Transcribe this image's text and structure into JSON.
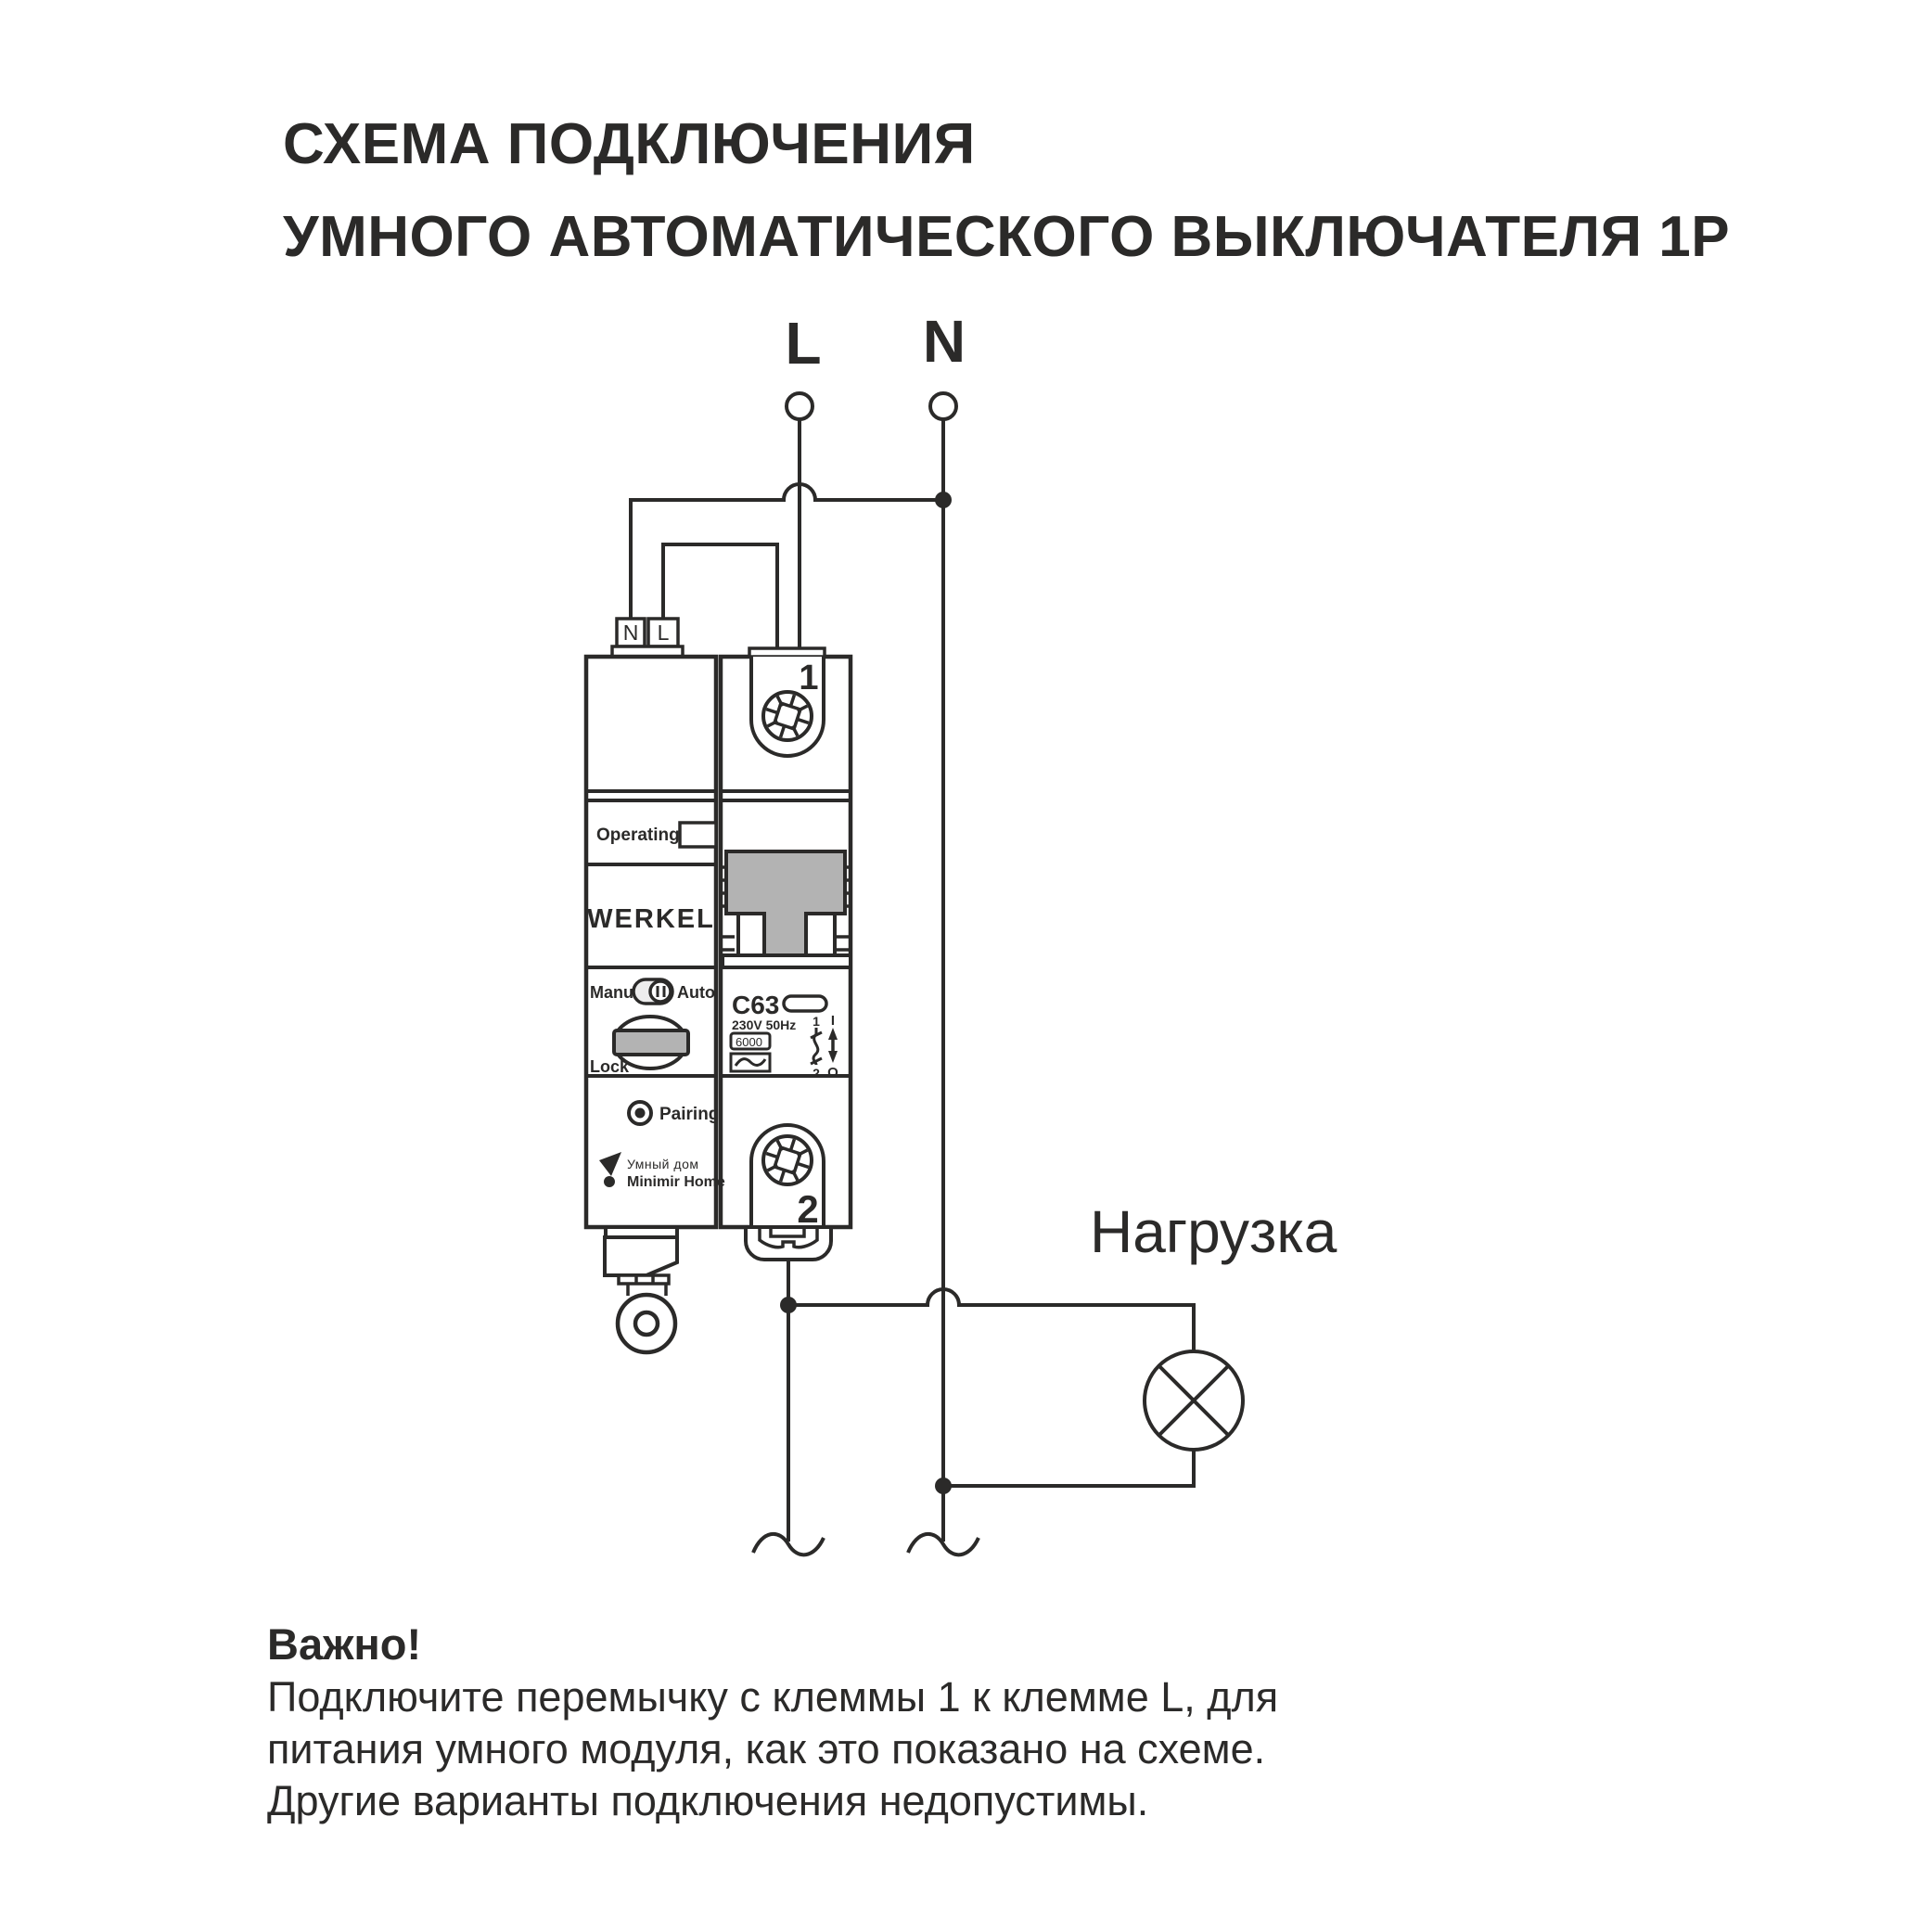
{
  "colors": {
    "line": "#2b2a29",
    "gray_fill": "#b3b3b3",
    "toggle_fill": "#ededed",
    "white": "#ffffff"
  },
  "title": {
    "line1": "СХЕМА ПОДКЛЮЧЕНИЯ",
    "line2": "УМНОГО АВТОМАТИЧЕСКОГО ВЫКЛЮЧАТЕЛЯ 1P"
  },
  "supply": {
    "l": "L",
    "n": "N"
  },
  "load": {
    "label": "Нагрузка"
  },
  "module": {
    "terminal_n": "N",
    "terminal_l": "L",
    "operating": "Operating",
    "brand": "WERKEL",
    "manu": "Manu",
    "auto": "Auto",
    "lock": "Lock",
    "pairing": "Pairing",
    "logo_top": "Умный дом",
    "logo_bottom": "Minimir Home"
  },
  "breaker": {
    "terminal1": "1",
    "terminal2": "2",
    "rating": "C63",
    "voltage": "230V 50Hz",
    "capacity": "6000",
    "contact_top": "1",
    "contact_bottom": "2",
    "on": "I",
    "off": "O"
  },
  "note": {
    "heading": "Важно!",
    "lines": [
      "Подключите перемычку с клеммы 1 к клемме L, для",
      "питания умного модуля, как это показано на схеме.",
      "Другие варианты подключения недопустимы."
    ]
  }
}
